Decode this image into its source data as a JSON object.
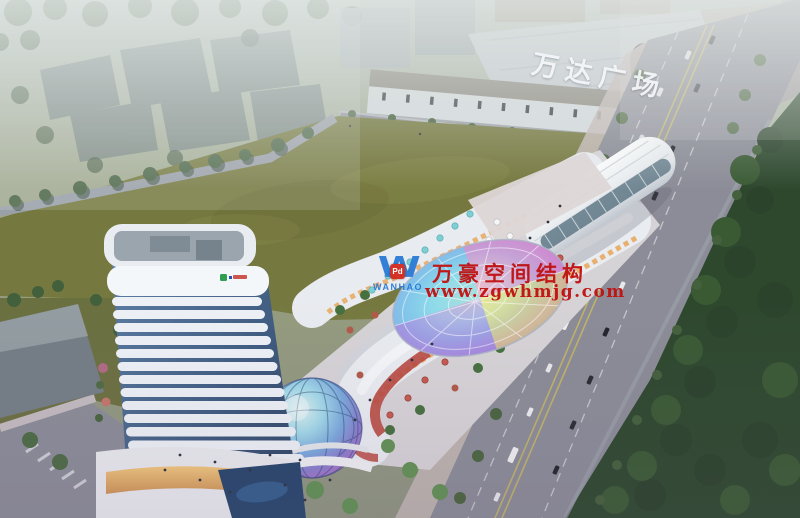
{
  "signage": {
    "wanda_plaza_sign": "万达广场"
  },
  "watermark": {
    "logo_word": "WANHAO",
    "logo_badge": "Pd",
    "line1": "万豪空间结构",
    "line2": "www.zgwhmjg.com",
    "text_color": "#c01010",
    "logo_color": "#2b7bd6",
    "badge_color": "#d22a1e"
  },
  "palette": {
    "lawn": "#76793f",
    "road": "#8b8c97",
    "green_belt": "#2e482e",
    "tower_white": "#edf1f6",
    "canopy_cyan": "#57c8e8",
    "canopy_purple": "#8f6fd8",
    "canopy_yellow": "#efd94f",
    "canopy_pink": "#ef74b8",
    "storefront_warm": "#e8a860",
    "accent_red": "#b8493f"
  }
}
